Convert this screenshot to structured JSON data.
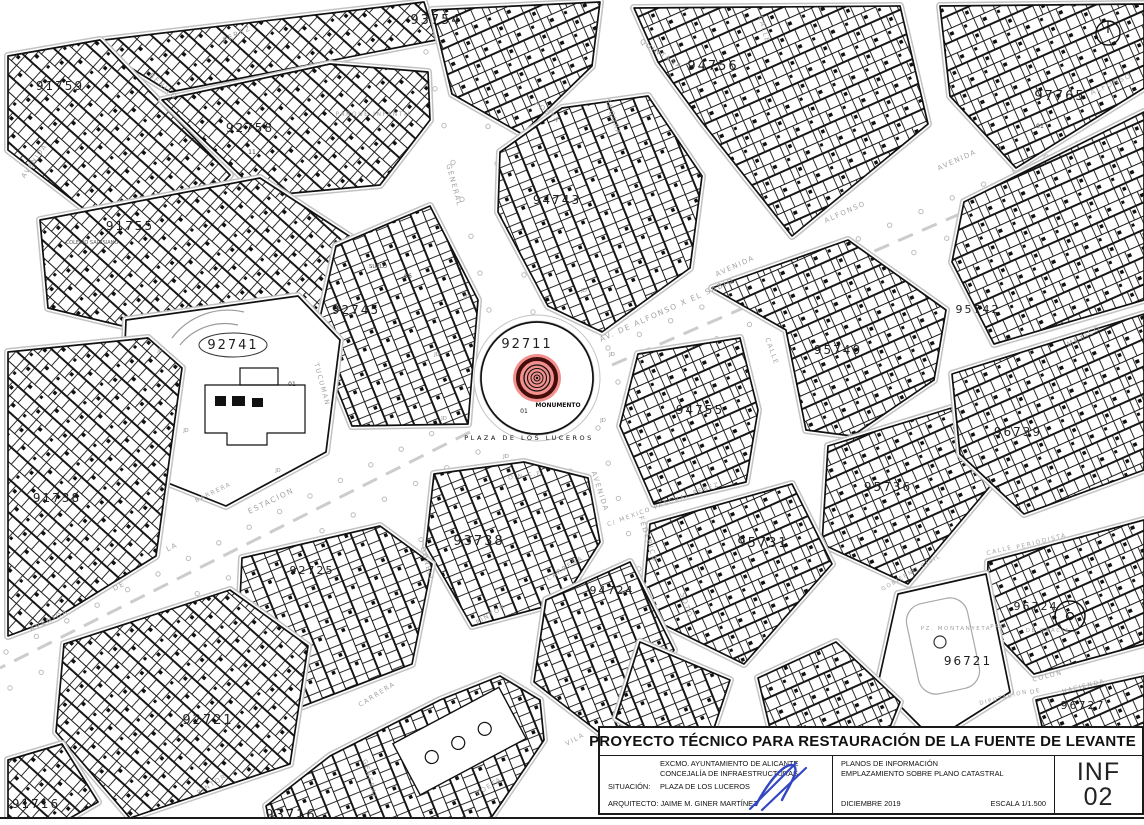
{
  "map": {
    "colors": {
      "line": "#111111",
      "curb": "#c2c2c2",
      "street_label": "#a3a3a3",
      "monument_fill": "#f2908d",
      "monument_ring": "#450c0c",
      "signature": "#3346c2"
    },
    "plaza": {
      "parcel": "92711",
      "monument": "MONUMENTO",
      "point": "01",
      "name": "PLAZA DE LOS LUCEROS"
    },
    "parcel_labels": [
      {
        "t": "91759",
        "x": 60,
        "y": 90,
        "s": 12
      },
      {
        "t": "93754",
        "x": 436,
        "y": 24,
        "s": 13
      },
      {
        "t": "94756",
        "x": 713,
        "y": 70,
        "s": 13
      },
      {
        "t": "97765",
        "x": 1060,
        "y": 100,
        "s": 13
      },
      {
        "t": "92758",
        "x": 250,
        "y": 132,
        "s": 12
      },
      {
        "t": "91755",
        "x": 130,
        "y": 230,
        "s": 12
      },
      {
        "t": "94743",
        "x": 557,
        "y": 204,
        "s": 12
      },
      {
        "t": "92745",
        "x": 356,
        "y": 314,
        "s": 12
      },
      {
        "t": "92741",
        "x": 233,
        "y": 349,
        "s": 13,
        "circ": true
      },
      {
        "t": "91738",
        "x": 57,
        "y": 502,
        "s": 12
      },
      {
        "t": "95740",
        "x": 838,
        "y": 354,
        "s": 12
      },
      {
        "t": "95742",
        "x": 978,
        "y": 313,
        "s": 11
      },
      {
        "t": "94755",
        "x": 700,
        "y": 414,
        "s": 12
      },
      {
        "t": "95736",
        "x": 888,
        "y": 491,
        "s": 12
      },
      {
        "t": "96739",
        "x": 1018,
        "y": 436,
        "s": 12
      },
      {
        "t": "95731",
        "x": 763,
        "y": 547,
        "s": 13
      },
      {
        "t": "96724",
        "x": 1036,
        "y": 610,
        "s": 11
      },
      {
        "t": "96721",
        "x": 968,
        "y": 665,
        "s": 12
      },
      {
        "t": "96727",
        "x": 1083,
        "y": 709,
        "s": 11
      },
      {
        "t": "92721",
        "x": 208,
        "y": 724,
        "s": 13
      },
      {
        "t": "92725",
        "x": 312,
        "y": 574,
        "s": 11
      },
      {
        "t": "93738",
        "x": 479,
        "y": 545,
        "s": 13
      },
      {
        "t": "94724",
        "x": 612,
        "y": 594,
        "s": 11
      },
      {
        "t": "93716",
        "x": 291,
        "y": 819,
        "s": 13
      },
      {
        "t": "91716",
        "x": 36,
        "y": 808,
        "s": 12
      }
    ],
    "street_labels": [
      {
        "t": "PEREZ",
        "x": 238,
        "y": 36,
        "r": -25,
        "s": 7
      },
      {
        "t": "BENITO",
        "x": 162,
        "y": 88,
        "r": 42,
        "s": 7
      },
      {
        "t": "AVENIDA",
        "x": 36,
        "y": 162,
        "r": -55,
        "s": 6.5
      },
      {
        "t": "PARQUE INFANTIL",
        "x": 374,
        "y": 116,
        "r": 0,
        "s": 6
      },
      {
        "t": "GENERAL",
        "x": 452,
        "y": 186,
        "r": 75,
        "s": 7
      },
      {
        "t": "POETA",
        "x": 546,
        "y": 114,
        "r": 38,
        "s": 7
      },
      {
        "t": "SEGURA",
        "x": 611,
        "y": 118,
        "r": 72,
        "s": 7
      },
      {
        "t": "QUINTANA",
        "x": 660,
        "y": 56,
        "r": 33,
        "s": 7
      },
      {
        "t": "AV. DE ALFONSO X EL SABIO",
        "x": 668,
        "y": 312,
        "r": -24,
        "s": 7.5
      },
      {
        "t": "AVENIDA",
        "x": 736,
        "y": 268,
        "r": -24,
        "s": 7
      },
      {
        "t": "ALFONSO",
        "x": 846,
        "y": 214,
        "r": -24,
        "s": 7
      },
      {
        "t": "AVENIDA",
        "x": 958,
        "y": 162,
        "r": -24,
        "s": 7
      },
      {
        "t": "ALFONSO",
        "x": 1112,
        "y": 86,
        "r": -24,
        "s": 7
      },
      {
        "t": "CALLE",
        "x": 762,
        "y": 30,
        "r": 75,
        "s": 6.5
      },
      {
        "t": "CALLE",
        "x": 770,
        "y": 352,
        "r": 70,
        "s": 6.5
      },
      {
        "t": "MEXICO",
        "x": 1085,
        "y": 338,
        "r": -28,
        "s": 7
      },
      {
        "t": "ESTACION",
        "x": 272,
        "y": 503,
        "r": -26,
        "s": 7.5
      },
      {
        "t": "LA",
        "x": 173,
        "y": 549,
        "r": -26,
        "s": 7
      },
      {
        "t": "DE",
        "x": 120,
        "y": 588,
        "r": -26,
        "s": 7
      },
      {
        "t": "AVENIDA",
        "x": 50,
        "y": 622,
        "r": -26,
        "s": 7
      },
      {
        "t": "BARRERA",
        "x": 214,
        "y": 494,
        "r": -26,
        "s": 6
      },
      {
        "t": "TUCUMAN",
        "x": 320,
        "y": 385,
        "r": 75,
        "s": 6.5
      },
      {
        "t": "O'DONELL",
        "x": 424,
        "y": 560,
        "r": 75,
        "s": 6.5
      },
      {
        "t": "GENERAL",
        "x": 368,
        "y": 780,
        "r": 75,
        "s": 6.5
      },
      {
        "t": "CARRERA",
        "x": 566,
        "y": 570,
        "r": -32,
        "s": 6.5
      },
      {
        "t": "CARRERA",
        "x": 378,
        "y": 696,
        "r": -32,
        "s": 6.5
      },
      {
        "t": "PINTOR",
        "x": 492,
        "y": 616,
        "r": -32,
        "s": 6.5
      },
      {
        "t": "PINTOR",
        "x": 213,
        "y": 786,
        "r": -32,
        "s": 6.5
      },
      {
        "t": "AVENIDA",
        "x": 598,
        "y": 492,
        "r": 72,
        "s": 7
      },
      {
        "t": "FEDERICO",
        "x": 646,
        "y": 540,
        "r": 72,
        "s": 7
      },
      {
        "t": "SOTO",
        "x": 684,
        "y": 606,
        "r": 72,
        "s": 7
      },
      {
        "t": "C/ MEXICO PASCUAL PEREZ",
        "x": 664,
        "y": 506,
        "r": -20,
        "s": 6
      },
      {
        "t": "VILA",
        "x": 576,
        "y": 741,
        "r": -28,
        "s": 6.5
      },
      {
        "t": "POETA",
        "x": 490,
        "y": 788,
        "r": -32,
        "s": 6.5
      },
      {
        "t": "COLON",
        "x": 1048,
        "y": 678,
        "r": -14,
        "s": 6.5
      },
      {
        "t": "DE",
        "x": 1036,
        "y": 693,
        "r": -14,
        "s": 6
      },
      {
        "t": "HACIENDA",
        "x": 1084,
        "y": 688,
        "r": -14,
        "s": 6
      },
      {
        "t": "DIPUTACION",
        "x": 1004,
        "y": 699,
        "r": -14,
        "s": 5.5
      },
      {
        "t": "CALLE",
        "x": 1000,
        "y": 552,
        "r": -14,
        "s": 6
      },
      {
        "t": "PERIODISTA",
        "x": 1042,
        "y": 543,
        "r": -14,
        "s": 6
      },
      {
        "t": "PZ. MONTANYETA",
        "x": 956,
        "y": 630,
        "r": 0,
        "s": 5.5
      },
      {
        "t": "PRQ.",
        "x": 1000,
        "y": 628,
        "r": 0,
        "s": 5.5
      },
      {
        "t": "DE GRACIA",
        "x": 1048,
        "y": 632,
        "r": 0,
        "s": 5.5
      },
      {
        "t": "GOBIERNO CIVIL",
        "x": 912,
        "y": 574,
        "r": -30,
        "s": 5.5
      },
      {
        "t": "O.N.C.E.",
        "x": 527,
        "y": 477,
        "r": -8,
        "s": 6
      }
    ],
    "misc_labels": [
      {
        "t": "COLEGIO SALESIANO",
        "x": 92,
        "y": 244,
        "s": 5,
        "c": "#555555"
      },
      {
        "t": "SUELO",
        "x": 378,
        "y": 268,
        "s": 5.5,
        "c": "#444444"
      },
      {
        "t": "06",
        "x": 408,
        "y": 278,
        "s": 6,
        "c": "#333333"
      },
      {
        "t": "01",
        "x": 292,
        "y": 386,
        "s": 6,
        "c": "#333333"
      },
      {
        "t": "01",
        "x": 1040,
        "y": 128,
        "s": 6,
        "c": "#333333"
      },
      {
        "t": "11",
        "x": 252,
        "y": 154,
        "s": 6,
        "c": "#333333"
      },
      {
        "t": "JD",
        "x": 467,
        "y": 298,
        "s": 5.5,
        "c": "#909090"
      },
      {
        "t": "JD",
        "x": 584,
        "y": 292,
        "s": 5.5,
        "c": "#909090"
      },
      {
        "t": "JD",
        "x": 612,
        "y": 356,
        "s": 5.5,
        "c": "#909090"
      },
      {
        "t": "JD",
        "x": 603,
        "y": 422,
        "s": 5.5,
        "c": "#909090"
      },
      {
        "t": "JD",
        "x": 506,
        "y": 458,
        "s": 5.5,
        "c": "#909090"
      },
      {
        "t": "JD",
        "x": 444,
        "y": 420,
        "s": 5.5,
        "c": "#909090"
      },
      {
        "t": "JD",
        "x": 437,
        "y": 356,
        "s": 5.5,
        "c": "#909090"
      },
      {
        "t": "JD",
        "x": 160,
        "y": 352,
        "s": 5,
        "c": "#909090"
      },
      {
        "t": "JD",
        "x": 186,
        "y": 432,
        "s": 5,
        "c": "#909090"
      },
      {
        "t": "JD",
        "x": 278,
        "y": 472,
        "s": 5,
        "c": "#909090"
      }
    ]
  },
  "title_block": {
    "title": "PROYECTO TÉCNICO PARA RESTAURACIÓN DE LA FUENTE DE LEVANTE",
    "org_line1": "EXCMO. AYUNTAMIENTO DE ALICANTE",
    "org_line2": "CONCEJALÍA DE INFRAESTRUCTURAS",
    "situacion_label": "SITUACIÓN:",
    "situacion_value": "PLAZA DE LOS LUCEROS",
    "arquitecto_label": "ARQUITECTO:",
    "arquitecto_value": "JAIME M. GINER MARTÍNEZ",
    "col2_line1": "PLANOS DE INFORMACIÓN",
    "col2_line2": "EMPLAZAMIENTO SOBRE PLANO CATASTRAL",
    "date": "DICIEMBRE 2019",
    "scale": "ESCALA 1/1.500",
    "sheet_code": "INF",
    "sheet_number": "02"
  }
}
